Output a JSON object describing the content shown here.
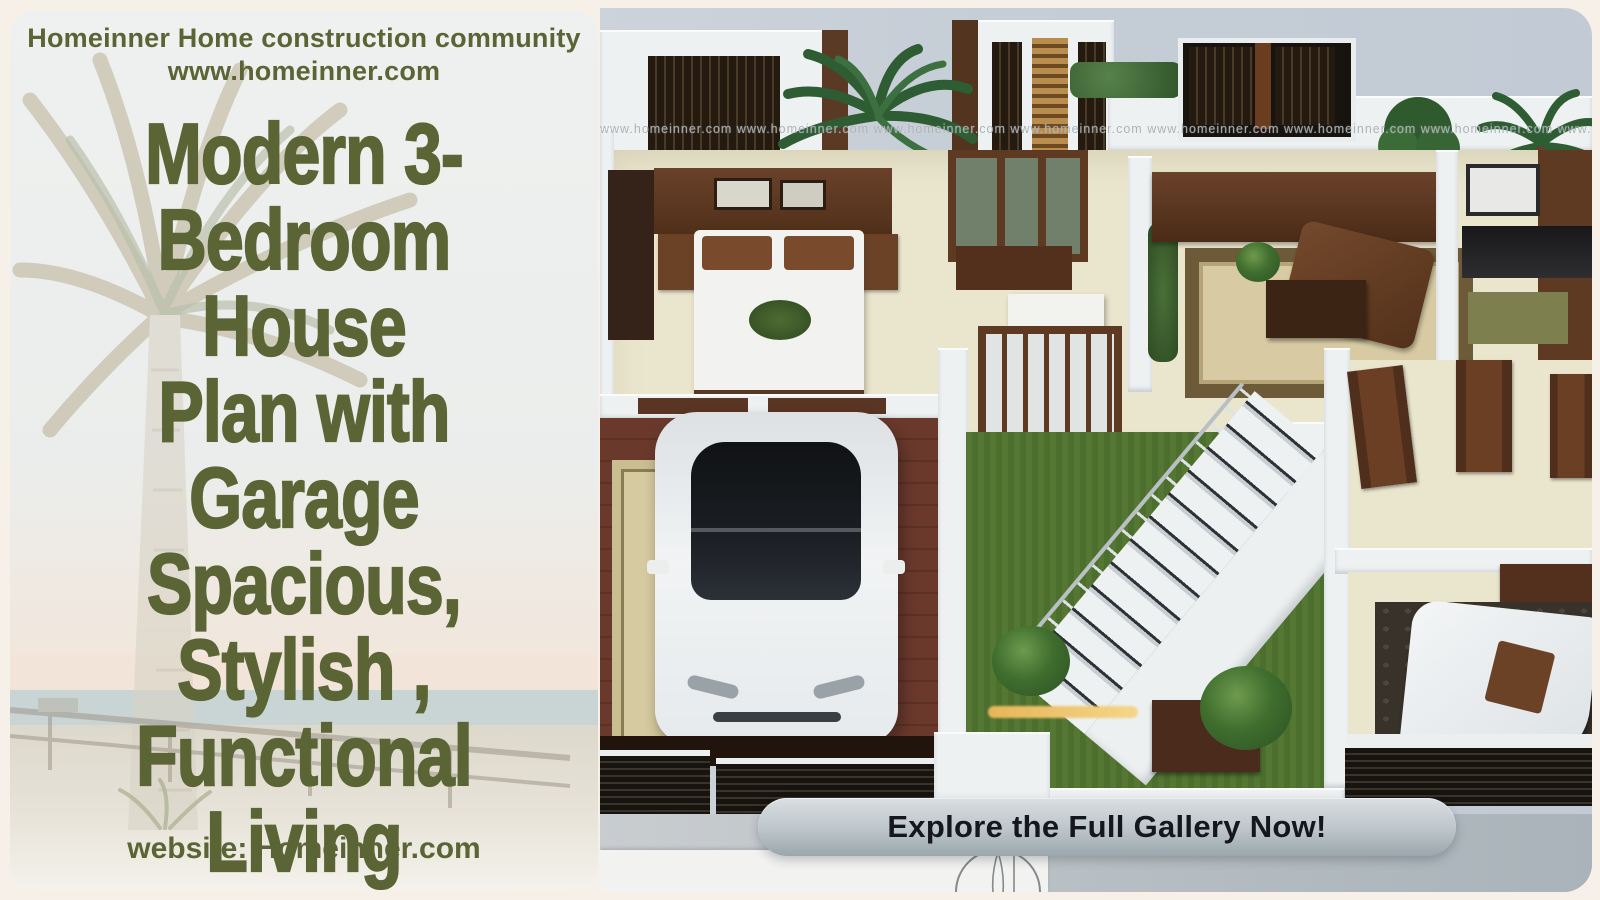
{
  "left_panel": {
    "header": {
      "line1": "Homeinner Home construction community",
      "line2": "www.homeinner.com"
    },
    "title": {
      "lines": [
        "Modern 3-",
        "Bedroom House",
        "Plan with",
        "Garage",
        "Spacious,",
        "Stylish ,",
        "Functional",
        "Living"
      ]
    },
    "footer": {
      "text": "website: Homeinner.com"
    },
    "accent_color": "#5a6434"
  },
  "render": {
    "watermark": "www.homeinner.com www.homeinner.com www.homeinner.com www.homeinner.com www.homeinner.com www.homeinner.com www.homeinner.com www.homeinner.com www.homeinner.com",
    "cta_label": "Explore the Full Gallery Now!",
    "palette": {
      "sky": "#c5cdd6",
      "lawn": "#547733",
      "garage_floor": "#63352a",
      "wood": "#6b4226",
      "floor": "#eae5cd",
      "cta_text": "#14171b"
    }
  },
  "icons": {
    "bottom_logo": "architect-compass-logo-icon",
    "palm_tree": "palm-tree-icon"
  }
}
